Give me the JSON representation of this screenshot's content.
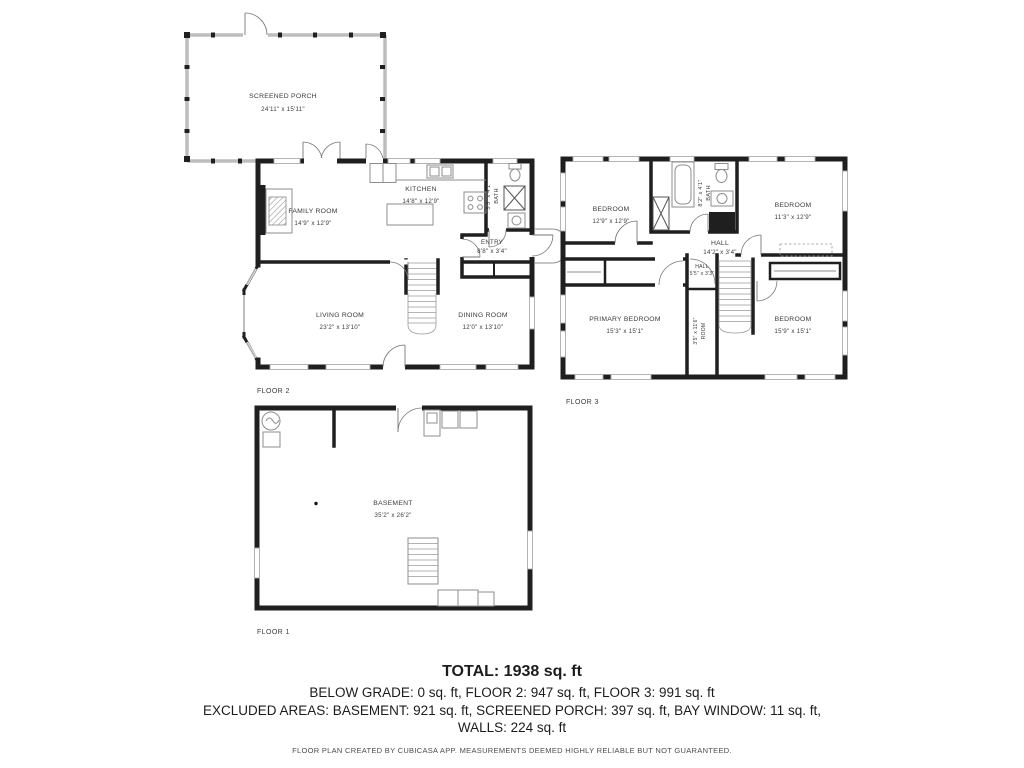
{
  "porch": {
    "name": "SCREENED PORCH",
    "dims": "24'11\" x 15'11\""
  },
  "floor2": {
    "label": "FLOOR 2",
    "family_room": {
      "name": "FAMILY ROOM",
      "dims": "14'9\" x 12'9\""
    },
    "kitchen": {
      "name": "KITCHEN",
      "dims": "14'8\" x 12'9\""
    },
    "bath": {
      "name": "BATH",
      "dims": "5'5\" x 4'1\""
    },
    "entry": {
      "name": "ENTRY",
      "dims": "8'8\" x 3'4\""
    },
    "living_room": {
      "name": "LIVING ROOM",
      "dims": "23'2\" x 13'10\""
    },
    "dining_room": {
      "name": "DINING ROOM",
      "dims": "12'0\" x 13'10\""
    }
  },
  "floor3": {
    "label": "FLOOR 3",
    "bedroom_top_left": {
      "name": "BEDROOM",
      "dims": "12'9\" x 12'9\""
    },
    "bath": {
      "name": "BATH",
      "dims": "8'2\" x 4'1\""
    },
    "bedroom_top_right": {
      "name": "BEDROOM",
      "dims": "11'3\" x 12'9\""
    },
    "hall": {
      "name": "HALL",
      "dims": "14'2\" x 3'4\""
    },
    "hall_small": {
      "name": "HALL",
      "dims": "5'5\" x 3'3\""
    },
    "room": {
      "name": "ROOM",
      "dims": "3'5\" x 11'6\""
    },
    "primary_bedroom": {
      "name": "PRIMARY BEDROOM",
      "dims": "15'3\" x 15'1\""
    },
    "bedroom_bottom_right": {
      "name": "BEDROOM",
      "dims": "15'9\" x 15'1\""
    }
  },
  "floor1": {
    "label": "FLOOR 1",
    "basement": {
      "name": "BASEMENT",
      "dims": "35'2\" x 26'2\""
    }
  },
  "summary": {
    "total": "TOTAL: 1938 sq. ft",
    "by_floor": "BELOW GRADE: 0 sq. ft, FLOOR 2: 947 sq. ft, FLOOR 3: 991 sq. ft",
    "excluded": "EXCLUDED AREAS: BASEMENT: 921 sq. ft, SCREENED PORCH: 397 sq. ft, BAY WINDOW: 11 sq. ft,",
    "walls": "WALLS: 224 sq. ft",
    "disclaimer": "FLOOR PLAN CREATED BY CUBICASA APP. MEASUREMENTS DEEMED HIGHLY RELIABLE BUT NOT GUARANTEED."
  },
  "colors": {
    "wall": "#1f1f1f",
    "screen_wall": "#bdbdbd",
    "fixture": "#8d8d8d",
    "label": "#3b3b3b"
  }
}
